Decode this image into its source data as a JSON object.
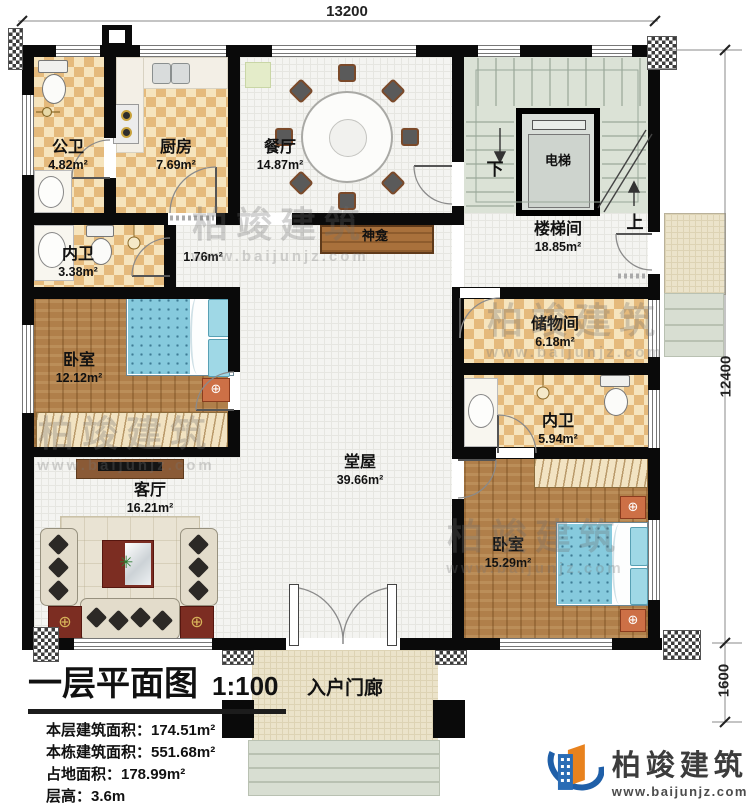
{
  "dimensions": {
    "top": "13200",
    "side": "12400",
    "porch": "1600"
  },
  "rooms": {
    "gongwei": {
      "name": "公卫",
      "area": "4.82m²"
    },
    "chufang": {
      "name": "厨房",
      "area": "7.69m²"
    },
    "canting": {
      "name": "餐厅",
      "area": "14.87m²"
    },
    "dianti": {
      "name": "电梯"
    },
    "loutijian": {
      "name": "楼梯间",
      "area": "18.85m²"
    },
    "neiwei_a": {
      "name": "内卫",
      "area": "3.38m²"
    },
    "guodao": {
      "area": "1.76m²"
    },
    "shenkan": {
      "name": "神龛"
    },
    "woshi_a": {
      "name": "卧室",
      "area": "12.12m²"
    },
    "chuwujian": {
      "name": "储物间",
      "area": "6.18m²"
    },
    "neiwei_b": {
      "name": "内卫",
      "area": "5.94m²"
    },
    "tangwu": {
      "name": "堂屋",
      "area": "39.66m²"
    },
    "keting": {
      "name": "客厅",
      "area": "16.21m²"
    },
    "woshi_b": {
      "name": "卧室",
      "area": "15.29m²"
    },
    "menlang": {
      "name": "入户门廊"
    }
  },
  "stairs": {
    "down": "下",
    "up": "上"
  },
  "title_block": {
    "title": "一层平面图",
    "scale": "1:100",
    "rows": [
      "本层建筑面积：174.51m²",
      "本栋建筑面积：551.68m²",
      "占地面积：178.99m²",
      "层高：3.6m"
    ]
  },
  "branding": {
    "company": "柏竣建筑",
    "website": "www.baijunjz.com"
  },
  "watermark": {
    "text": "柏竣建筑",
    "website": "www.baijunjz.com"
  },
  "colors": {
    "wall": "#0a0a0a",
    "checker_tile": "#e5ba7c",
    "wood_floor": "#b07f4a",
    "stair_green": "#dbe2d6",
    "bed_blue": "#86cadd",
    "accent_red": "#7c2d22",
    "brand_blue": "#1f5fa8",
    "brand_orange": "#e8821e"
  }
}
